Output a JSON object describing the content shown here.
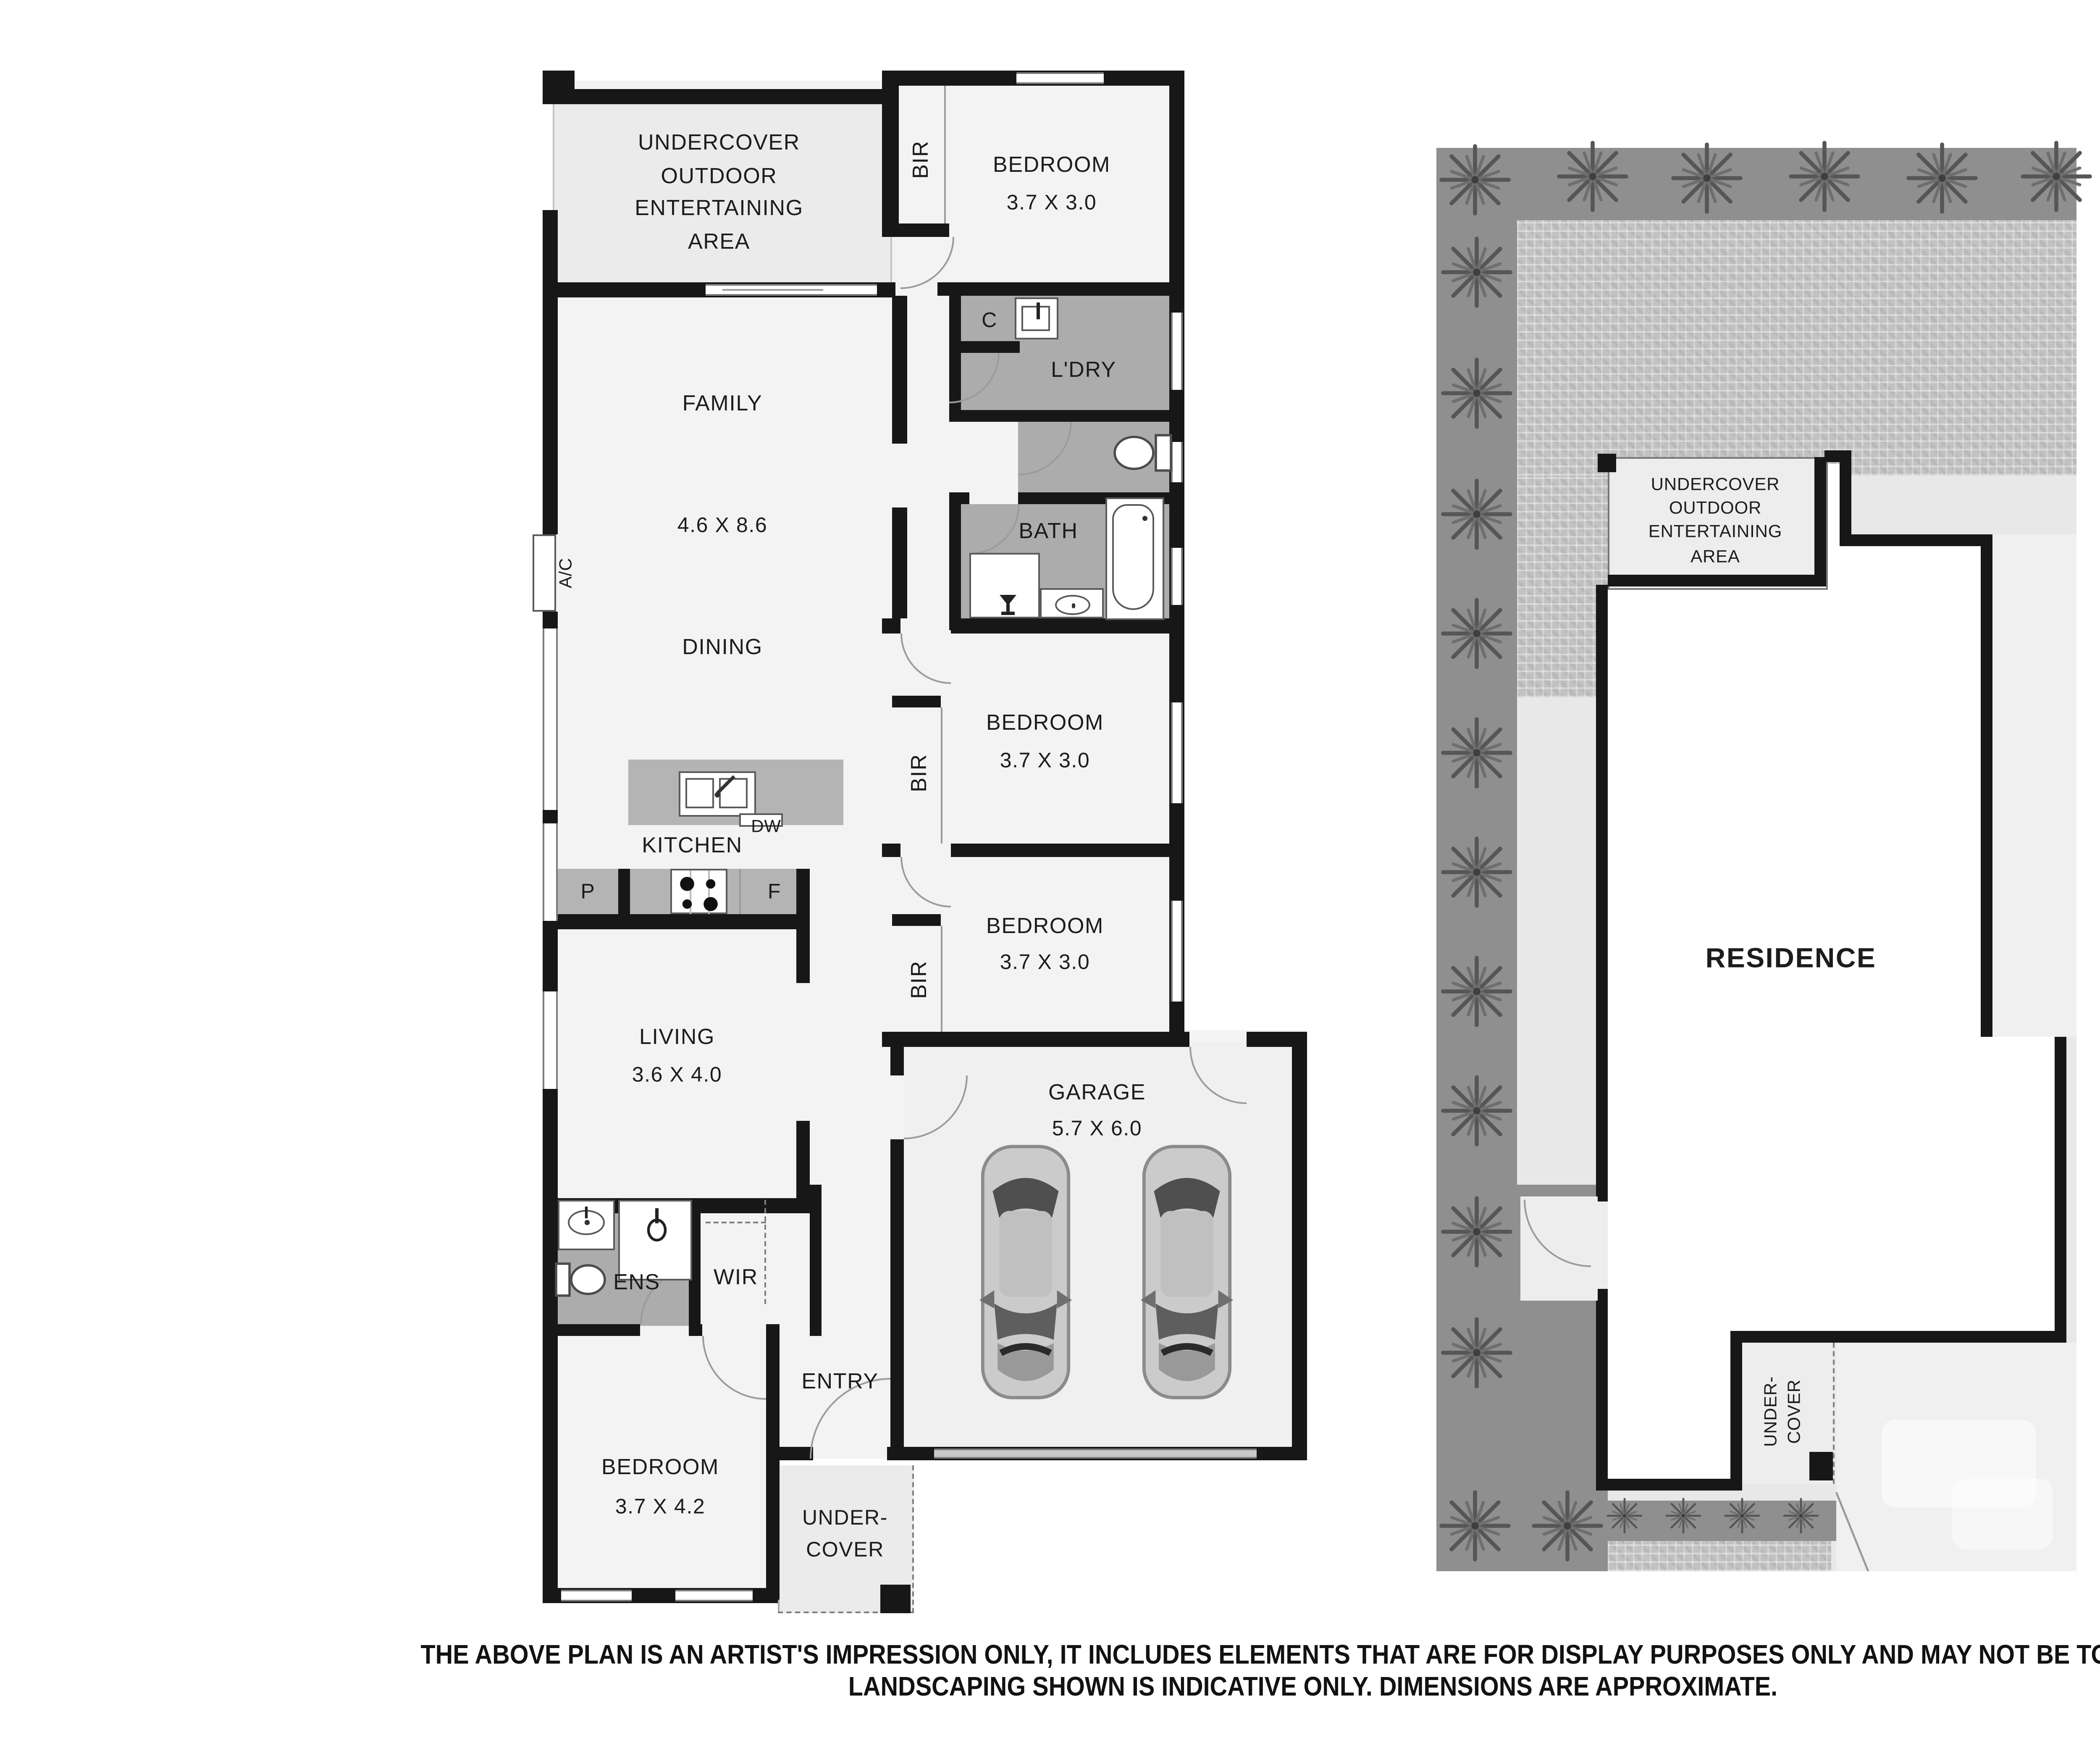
{
  "floor_plan": {
    "outdoor_area_label": "UNDERCOVER\nOUTDOOR\nENTERTAINING\nAREA",
    "bir_label": "BIR",
    "bedroom1": {
      "name": "BEDROOM",
      "dims": "3.7 X 3.0"
    },
    "closet_label": "C",
    "laundry_label": "L'DRY",
    "family_label": "FAMILY",
    "family_dims": "4.6 X 8.6",
    "dining_label": "DINING",
    "bath_label": "BATH",
    "ac_label": "A/C",
    "kitchen_label": "KITCHEN",
    "dishwasher_label": "DW",
    "pantry_label": "P",
    "fridge_label": "F",
    "bedroom2": {
      "name": "BEDROOM",
      "dims": "3.7 X 3.0"
    },
    "bedroom3": {
      "name": "BEDROOM",
      "dims": "3.7 X 3.0"
    },
    "living": {
      "name": "LIVING",
      "dims": "3.6 X 4.0"
    },
    "garage": {
      "name": "GARAGE",
      "dims": "5.7 X 6.0"
    },
    "ensuite_label": "ENS",
    "wir_label": "WIR",
    "entry_label": "ENTRY",
    "bedroom4": {
      "name": "BEDROOM",
      "dims": "3.7 X 4.2"
    },
    "undercover_porch_label": "UNDER-\nCOVER"
  },
  "site_plan": {
    "outdoor_area_label": "UNDERCOVER\nOUTDOOR\nENTERTAINING\nAREA",
    "residence_label": "RESIDENCE",
    "undercover_label": "UNDER-\nCOVER"
  },
  "compass": {
    "north_label": "N"
  },
  "disclaimer": {
    "line1": "THE ABOVE PLAN IS AN ARTIST'S IMPRESSION ONLY, IT INCLUDES ELEMENTS THAT ARE FOR DISPLAY PURPOSES ONLY AND MAY NOT BE TO SCALE.",
    "line2": "LANDSCAPING SHOWN IS INDICATIVE ONLY. DIMENSIONS ARE APPROXIMATE."
  },
  "colors": {
    "wall": "#171717",
    "floor": "#f3f3f3",
    "wet_area": "#acacac",
    "kitchen_bench": "#b4b4b4",
    "outdoor_area": "#ebebeb",
    "site_plot": "#e8e8e8",
    "site_garden_strip": "#8f8f8f",
    "site_paving": "#c2c2c2",
    "residence_fill": "#ffffff",
    "tree": "#5f5f5f",
    "text": "#1c1c1c"
  }
}
